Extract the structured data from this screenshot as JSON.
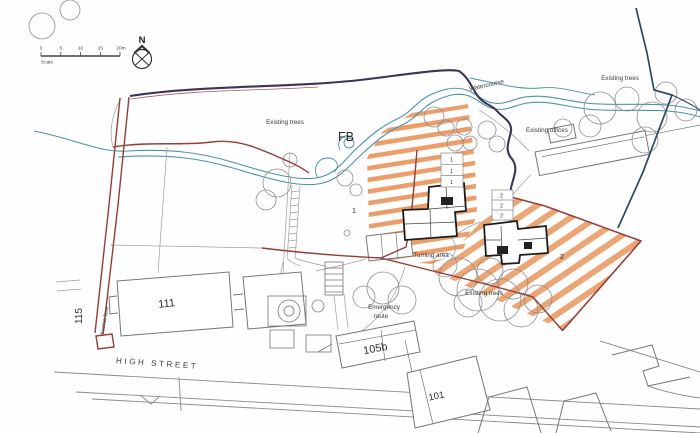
{
  "drawing": {
    "scale_bar": {
      "ticks": [
        "0",
        "5",
        "10",
        "15",
        "20m"
      ],
      "label": "Scale"
    },
    "compass": {
      "north": "N"
    },
    "labels": {
      "existing_trees_belt": "Existing trees",
      "watercourse": "Watercourse",
      "existing_trees_topright": "Existing trees",
      "existing_offices": "Existing offices",
      "footbridge": "FB",
      "turning_area": "Turning area",
      "emergency_route_line1": "Emergency",
      "emergency_route_line2": "route",
      "existing_trees_center": "Existing trees",
      "access_lane": "Access lane",
      "high_street": "HIGH STREET"
    },
    "plot_numbers": {
      "plot1": "1",
      "plot2": "2"
    },
    "parking_bays": {
      "plot1": [
        "1",
        "1",
        "1"
      ],
      "plot2": [
        "2",
        "2",
        "2"
      ]
    },
    "house_numbers": {
      "no111": "111",
      "no115": "115",
      "no105b": "105b",
      "no101": "101"
    },
    "colors": {
      "boundary_red": "#943e3a",
      "boundary_dark": "#3d3456",
      "watercourse_teal": "#4e93a3",
      "hatch_orange": "#e5833f",
      "line_gray": "#7a7a7a",
      "text": "#3a3a3a"
    }
  }
}
